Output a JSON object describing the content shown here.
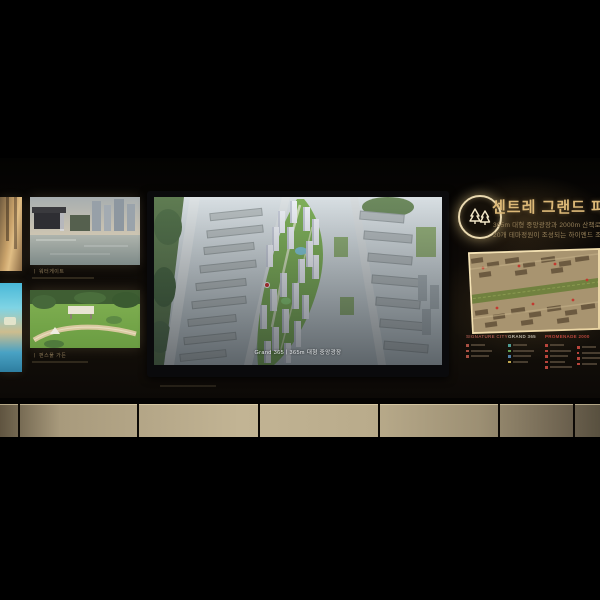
{
  "left_panel": {
    "frames": [
      {
        "caption": "ㅣ 워터게이트"
      },
      {
        "caption": "ㅣ 펀스풀 가든"
      }
    ]
  },
  "tv": {
    "caption": "Grand 365ㅣ365m 대형 중앙광장"
  },
  "brand": {
    "logo": "twin-trees-emblem",
    "title": "센트레 그랜드 파크",
    "subtitle1": "365m 대형 중앙광장과 2000m 산책로",
    "subtitle2": "20개 테마정원이 조성되는 하이엔드 조경"
  },
  "legend": {
    "columns": [
      {
        "header": "SIGNATURE CITY",
        "header_color": "#a0544a",
        "bullet_colors": [
          "#a85043",
          "#a85043",
          "#a85043"
        ]
      },
      {
        "header": "GRAND 365",
        "header_color": "#b9b2a2",
        "bullet_colors": [
          "#4f9d94",
          "#63a050",
          "#4f7fa8",
          "#c2a84f"
        ]
      },
      {
        "header": "PROMENADE 2000",
        "header_color": "#b9473d",
        "bullet_colors": [
          "#b8453c",
          "#b8453c",
          "#b8453c",
          "#b8453c",
          "#b8453c"
        ],
        "bullet_colors2": [
          "#b8453c",
          "#b8453c",
          "#b8453c",
          "#b8453c"
        ]
      }
    ]
  },
  "colors": {
    "accent_gold": "#dcb877",
    "cabinet_tan": "#b9ac8c",
    "map_beige": "#a89470",
    "legend_red": "#b8453c",
    "screen_green": "#7fb05a"
  }
}
